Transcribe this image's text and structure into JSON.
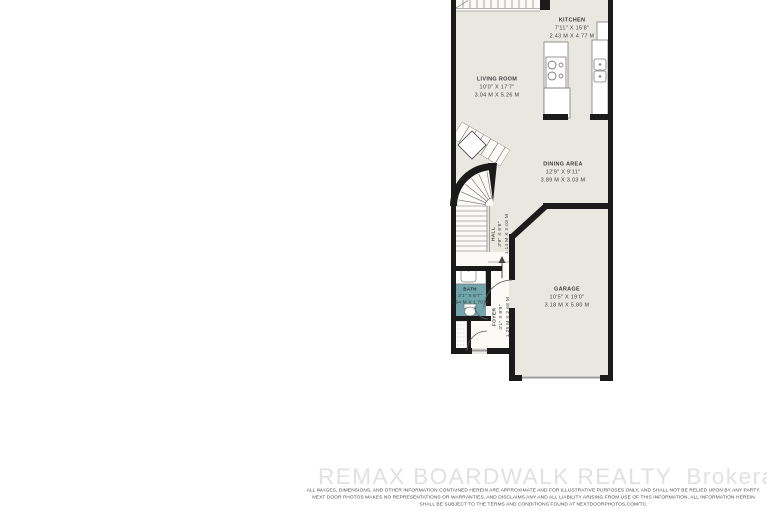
{
  "plan": {
    "title": "townhouse main floor plan",
    "rooms": [
      {
        "id": "kitchen",
        "name": "KITCHEN",
        "imperial": "7'11\" X 15'8\"",
        "metric": "2.43 M X 4.77 M"
      },
      {
        "id": "living-room",
        "name": "LIVING ROOM",
        "imperial": "10'0\" X 17'7\"",
        "metric": "3.04 M X 5.26 M"
      },
      {
        "id": "dining-area",
        "name": "DINING AREA",
        "imperial": "12'9\" X 9'11\"",
        "metric": "3.89 M X 3.03 M"
      },
      {
        "id": "hall",
        "name": "HALL",
        "imperial": "3'9\" X 6'8\"",
        "metric": "1.14 M X 2.03 M"
      },
      {
        "id": "bath",
        "name": "BATH",
        "imperial": "3'1\" X 5'7\"",
        "metric": "0.94 M X 1.70 M"
      },
      {
        "id": "foyer",
        "name": "FOYER",
        "imperial": "4'1\" X 8'9\"",
        "metric": "1.25 M X 2.68 M"
      },
      {
        "id": "garage",
        "name": "GARAGE",
        "imperial": "10'5\" X 19'0\"",
        "metric": "3.18 M X 5.80 M"
      }
    ]
  },
  "footer": {
    "brokerage_name": "REMAX BOARDWALK REALTY",
    "brokerage_suffix": "Brokerage",
    "disclaimer_line1": "ALL IMAGES, DIMENSIONS, AND OTHER INFORMATION CONTAINED HEREIN ARE APPROXIMATE AND FOR ILLUSTRATIVE PURPOSES ONLY, AND SHALL NOT BE RELIED UPON BY ANY PARTY.",
    "disclaimer_line2": "NEXT DOOR PHOTOS MAKES NO REPRESENTATIONS OR WARRANTIES, AND DISCLAIMS ANY AND ALL LIABILITY ARISING FROM USE OF THIS INFORMATION. ALL INFORMATION HEREIN",
    "disclaimer_line3": "SHALL BE SUBJECT TO THE TERMS AND CONDITIONS FOUND AT NEXTDOORPHOTOS.COM/TC."
  },
  "colors": {
    "wall": "#1b1b1b",
    "floor": "#e9e8e0",
    "stair": "#fbfaf7",
    "bath-floor": "#72a5ab",
    "label": "#3d3d3d",
    "watermark": "#e2e1e1",
    "disclaimer": "#4a4a4a"
  }
}
